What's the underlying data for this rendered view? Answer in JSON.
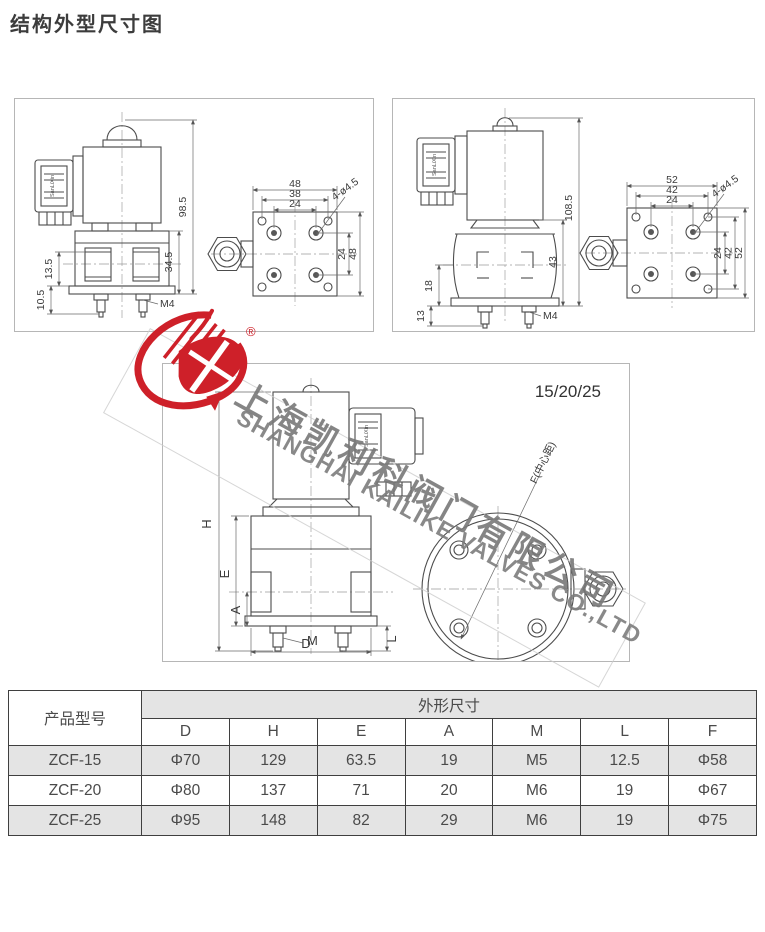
{
  "page": {
    "title": "结构外型尺寸图"
  },
  "watermark": {
    "cn": "上海凯利科阀门有限公司",
    "en": "SHANGHAI KAILIKE VALVES CO.,LTD",
    "registered": "®",
    "logo_red": "#ce2029",
    "text_gray": "#7a7a7a"
  },
  "drawing_small": {
    "coil_label": "SanLiXin",
    "dim_total_height": "98.5",
    "dim_body_height": "34.5",
    "dim_left_upper": "13.5",
    "dim_left_lower": "10.5",
    "dim_thread": "M4",
    "plate_w_outer": "48",
    "plate_w_mid": "38",
    "plate_w_inner": "24",
    "plate_h_inner": "24",
    "plate_h_outer": "48",
    "holes_label": "4-ø4.5"
  },
  "drawing_large": {
    "coil_label": "SanLiXin",
    "dim_total_height": "108.5",
    "dim_body_height": "43",
    "dim_left_upper": "18",
    "dim_left_lower": "13",
    "dim_thread": "M4",
    "plate_w_outer": "52",
    "plate_w_mid": "42",
    "plate_w_inner": "24",
    "plate_h_inner": "24",
    "plate_h_mid": "42",
    "plate_h_outer": "52",
    "holes_label": "4-ø4.5"
  },
  "drawing_generic": {
    "model_label": "15/20/25",
    "coil_label": "SanLiXin",
    "dim_h": "H",
    "dim_e": "E",
    "dim_a": "A",
    "dim_m": "M",
    "dim_d": "D",
    "dim_l": "L",
    "dim_f": "F(中心距)"
  },
  "table": {
    "model_header": "产品型号",
    "group_header": "外形尺寸",
    "columns": [
      "D",
      "H",
      "E",
      "A",
      "M",
      "L",
      "F"
    ],
    "rows": [
      {
        "model": "ZCF-15",
        "values": [
          "Φ70",
          "129",
          "63.5",
          "19",
          "M5",
          "12.5",
          "Φ58"
        ]
      },
      {
        "model": "ZCF-20",
        "values": [
          "Φ80",
          "137",
          "71",
          "20",
          "M6",
          "19",
          "Φ67"
        ]
      },
      {
        "model": "ZCF-25",
        "values": [
          "Φ95",
          "148",
          "82",
          "29",
          "M6",
          "19",
          "Φ75"
        ]
      }
    ]
  }
}
